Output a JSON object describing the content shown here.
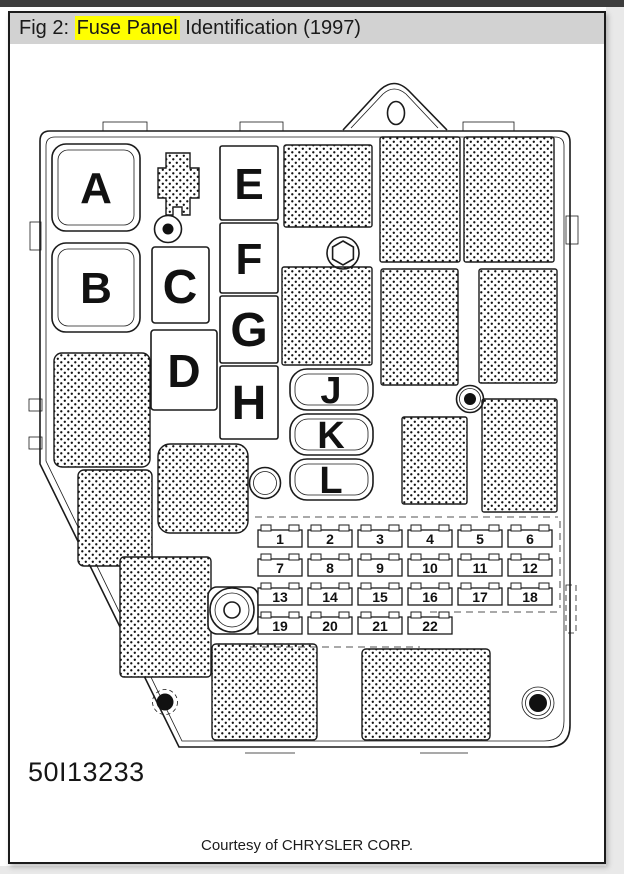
{
  "page": {
    "header": {
      "prefix": "Fig 2: ",
      "highlight": "Fuse Panel",
      "suffix": " Identification (1997)"
    },
    "figure_number": "50I13233",
    "caption": "Courtesy of CHRYSLER CORP."
  },
  "diagram": {
    "connector_labels": [
      "A",
      "B",
      "C",
      "D",
      "E",
      "F",
      "G",
      "H",
      "J",
      "K",
      "L"
    ],
    "fuse_numbers": [
      "1",
      "2",
      "3",
      "4",
      "5",
      "6",
      "7",
      "8",
      "9",
      "10",
      "11",
      "12",
      "13",
      "14",
      "15",
      "16",
      "17",
      "18",
      "19",
      "20",
      "21",
      "22"
    ]
  },
  "colors": {
    "highlight": "#ffff00",
    "header_bg": "#d2d2d2",
    "ink": "#1b1b1b"
  }
}
